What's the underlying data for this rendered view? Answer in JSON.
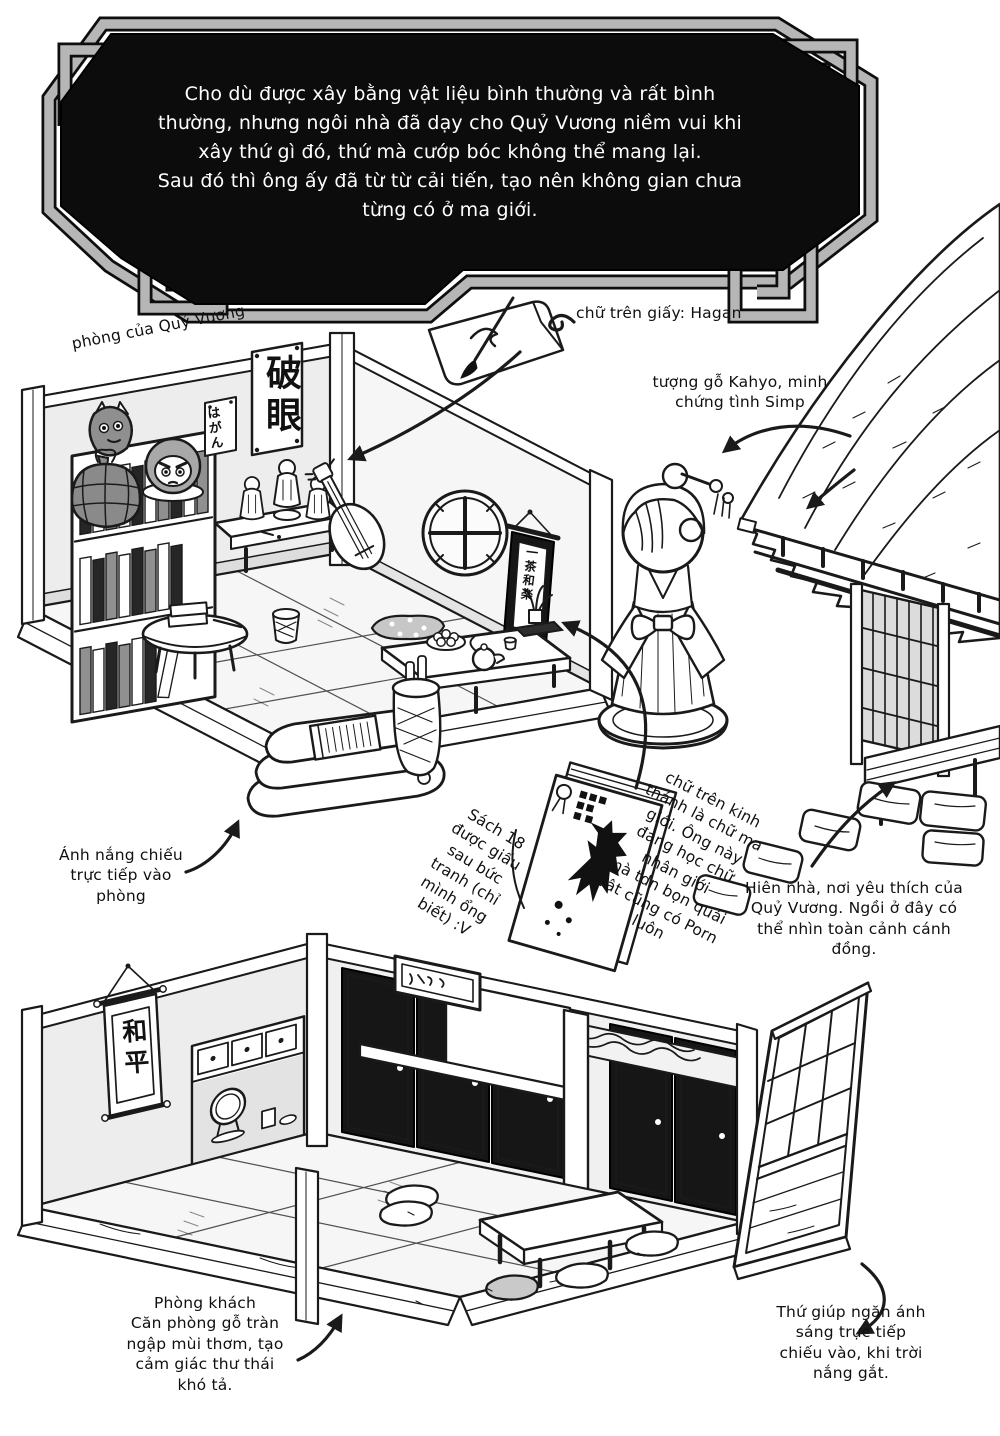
{
  "banner": {
    "text": "Cho dù được xây bằng vật liệu bình thường và rất bình\nthường, nhưng ngôi nhà đã dạy cho Quỷ Vương niềm vui khi\nxây thứ gì đó, thứ mà cướp bóc không thể mang lại.\nSau đó thì ông ấy đã từ từ cải tiến, tạo nên không gian chưa\ntừng có ở ma giới."
  },
  "annotations": {
    "room_label": "phòng của Quỷ Vương",
    "paper_label": "chữ trên giấy: Hagan",
    "statue_label": "tượng gỗ Kahyo, minh\nchứng tình Simp",
    "sunlight_label": "Ánh nắng chiếu\ntrực tiếp vào\nphòng",
    "hidden_book_label": "Sách 18\nđược giấu\nsau bức\ntranh (chỉ\nmình ổng\nbiết) :V",
    "bible_label": "chữ trên kinh\nthánh là chữ ma\ngiới. Ông này\nđang học chữ\nnhân giới\nmà tdn bọn quái\nvật cũng có Porn\nluôn",
    "porch_label": "Hiên nhà, nơi yêu thích của\nQuỷ Vương. Ngồi ở đây có\nthể nhìn toàn cảnh cánh\nđồng.",
    "living_room_label": "Phòng khách\nCăn phòng gỗ tràn\nngập mùi thơm, tạo\ncảm giác thư thái\nkhó tả.",
    "screen_label": "Thứ giúp ngăn ánh\nsáng trực tiếp\nchiếu vào, khi trời\nnắng gắt."
  },
  "artwork_text": {
    "hagan_scroll": "破眼",
    "hagan_sign": "はがん",
    "hanging_scroll": "一茶和楽",
    "peace_scroll": "和平"
  },
  "colors": {
    "ink": "#1a1a1a",
    "paper": "#ffffff",
    "banner_black": "#0c0c0c",
    "frame_gray": "#b6b6b6",
    "fusuma_dark": "#161616"
  }
}
